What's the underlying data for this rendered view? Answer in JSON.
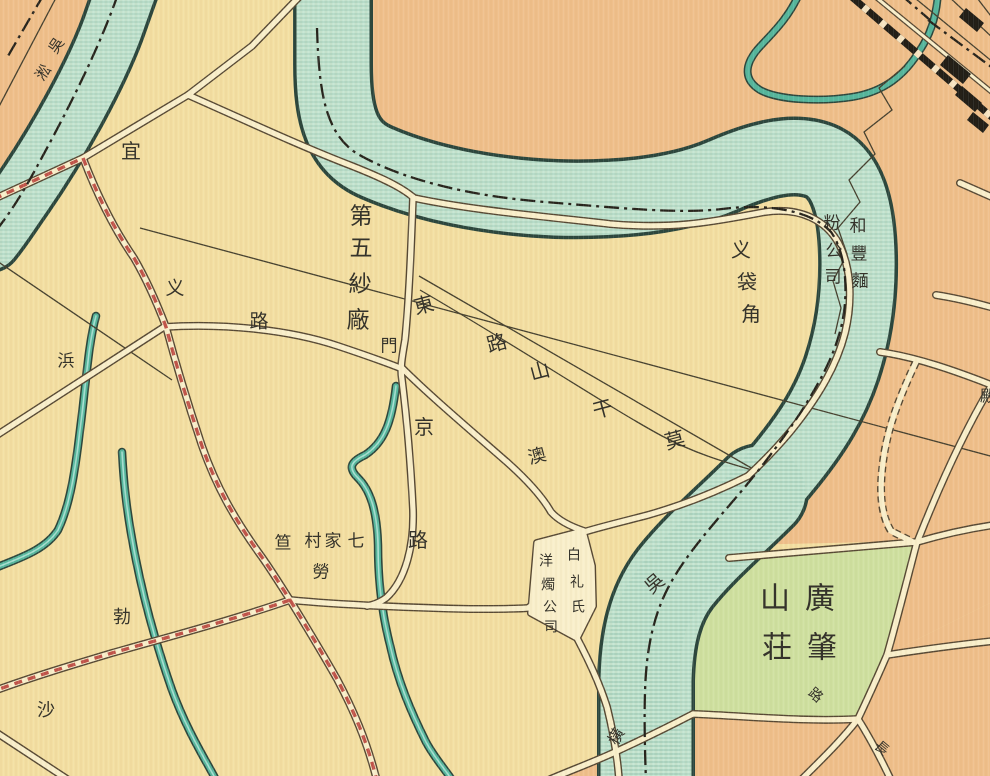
{
  "map": {
    "kind": "historical-chinese-city-map",
    "description_visible_features": "River bend with boundary dash-dot line, roads, factory district, cemetery green, railway in upper right",
    "palette": {
      "land_cream": "#f3dfa2",
      "land_orange": "#efbf8b",
      "land_green": "#cfe0a0",
      "water_fill": "#c5e5d1",
      "water_outline": "#2b463d",
      "water_hatch": "#84bba7",
      "water_small": "#55b69d",
      "water_small_hi": "#a5ded0",
      "road_fill": "#f9efcb",
      "road_casing": "#564834",
      "red_road": "#c0544a",
      "thin_line": "#45402f",
      "boundary": "#26231c",
      "rail": "#211e17",
      "ink": "#35332b"
    },
    "labels": [
      {
        "name": "label-yichang-road",
        "text": "宜",
        "chars": [
          {
            "c": "宜",
            "x": 131,
            "y": 152,
            "r": 0,
            "s": 20
          }
        ]
      },
      {
        "name": "label-creek-nw",
        "text": "吳淞",
        "chars": [
          {
            "c": "吳",
            "x": 57,
            "y": 46,
            "r": -55,
            "s": 15
          },
          {
            "c": "淞",
            "x": 44,
            "y": 73,
            "r": -55,
            "s": 15
          }
        ]
      },
      {
        "name": "label-no5-cotton-mill",
        "text": "第五紗廠",
        "chars": [
          {
            "c": "第",
            "x": 361,
            "y": 216,
            "r": 0,
            "s": 23
          },
          {
            "c": "五",
            "x": 361,
            "y": 248,
            "r": 0,
            "s": 23
          },
          {
            "c": "紗",
            "x": 360,
            "y": 284,
            "r": 0,
            "s": 23
          },
          {
            "c": "廠",
            "x": 358,
            "y": 320,
            "r": 0,
            "s": 23
          }
        ]
      },
      {
        "name": "label-gate",
        "text": "門",
        "chars": [
          {
            "c": "門",
            "x": 389,
            "y": 346,
            "r": 0,
            "s": 17
          }
        ]
      },
      {
        "name": "label-mokanshan-road-east",
        "text": "莫干山路東",
        "chars": [
          {
            "c": "東",
            "x": 424,
            "y": 306,
            "r": -15,
            "s": 20
          },
          {
            "c": "路",
            "x": 497,
            "y": 344,
            "r": -15,
            "s": 20
          },
          {
            "c": "山",
            "x": 540,
            "y": 372,
            "r": -15,
            "s": 20
          },
          {
            "c": "干",
            "x": 603,
            "y": 410,
            "r": -15,
            "s": 20
          },
          {
            "c": "莫",
            "x": 675,
            "y": 441,
            "r": -15,
            "s": 20
          }
        ]
      },
      {
        "name": "label-yi-road-west",
        "text": "义路",
        "chars": [
          {
            "c": "义",
            "x": 175,
            "y": 289,
            "r": 0,
            "s": 19
          },
          {
            "c": "路",
            "x": 259,
            "y": 322,
            "r": 0,
            "s": 19
          }
        ]
      },
      {
        "name": "label-bang-creek",
        "text": "浜",
        "chars": [
          {
            "c": "浜",
            "x": 66,
            "y": 361,
            "r": 0,
            "s": 17
          }
        ]
      },
      {
        "name": "label-jing-road",
        "text": "京路",
        "chars": [
          {
            "c": "京",
            "x": 424,
            "y": 428,
            "r": 0,
            "s": 20
          },
          {
            "c": "路",
            "x": 418,
            "y": 541,
            "r": 0,
            "s": 20
          }
        ]
      },
      {
        "name": "label-macao-road",
        "text": "澳",
        "chars": [
          {
            "c": "澳",
            "x": 537,
            "y": 456,
            "r": -15,
            "s": 18
          }
        ]
      },
      {
        "name": "label-yidaijiao",
        "text": "义袋角",
        "chars": [
          {
            "c": "义",
            "x": 741,
            "y": 251,
            "r": 0,
            "s": 20
          },
          {
            "c": "袋",
            "x": 747,
            "y": 283,
            "r": 0,
            "s": 20
          },
          {
            "c": "角",
            "x": 751,
            "y": 315,
            "r": 0,
            "s": 20
          }
        ]
      },
      {
        "name": "label-hefeng-flour-mill-right",
        "text": "和豐麵",
        "chars": [
          {
            "c": "和",
            "x": 858,
            "y": 226,
            "r": 0,
            "s": 17
          },
          {
            "c": "豐",
            "x": 859,
            "y": 254,
            "r": 0,
            "s": 17
          },
          {
            "c": "麵",
            "x": 860,
            "y": 281,
            "r": 0,
            "s": 17
          }
        ]
      },
      {
        "name": "label-hefeng-flour-mill-left",
        "text": "粉公司",
        "chars": [
          {
            "c": "粉",
            "x": 832,
            "y": 223,
            "r": 0,
            "s": 17
          },
          {
            "c": "公",
            "x": 834,
            "y": 251,
            "r": 0,
            "s": 17
          },
          {
            "c": "司",
            "x": 833,
            "y": 277,
            "r": 0,
            "s": 17
          }
        ]
      },
      {
        "name": "label-wusong-river",
        "text": "吳",
        "chars": [
          {
            "c": "吳",
            "x": 655,
            "y": 584,
            "r": -40,
            "s": 19
          }
        ]
      },
      {
        "name": "label-price-candle-right",
        "text": "白礼氏",
        "chars": [
          {
            "c": "白",
            "x": 574,
            "y": 556,
            "r": 0,
            "s": 14
          },
          {
            "c": "礼",
            "x": 577,
            "y": 583,
            "r": 0,
            "s": 14
          },
          {
            "c": "氏",
            "x": 578,
            "y": 608,
            "r": 0,
            "s": 14
          }
        ]
      },
      {
        "name": "label-price-candle-left",
        "text": "洋燭公司",
        "chars": [
          {
            "c": "洋",
            "x": 546,
            "y": 562,
            "r": 0,
            "s": 14
          },
          {
            "c": "燭",
            "x": 548,
            "y": 586,
            "r": 0,
            "s": 14
          },
          {
            "c": "公",
            "x": 550,
            "y": 608,
            "r": 0,
            "s": 14
          },
          {
            "c": "司",
            "x": 551,
            "y": 628,
            "r": 0,
            "s": 14
          }
        ]
      },
      {
        "name": "label-qijiacun-village",
        "text": "七家村笪",
        "chars": [
          {
            "c": "七",
            "x": 356,
            "y": 541,
            "r": 0,
            "s": 17
          },
          {
            "c": "家",
            "x": 333,
            "y": 541,
            "r": 0,
            "s": 17
          },
          {
            "c": "村",
            "x": 313,
            "y": 541,
            "r": 0,
            "s": 17
          },
          {
            "c": "笪",
            "x": 283,
            "y": 543,
            "r": 0,
            "s": 17
          }
        ]
      },
      {
        "name": "label-robison-road-lao",
        "text": "勞",
        "chars": [
          {
            "c": "勞",
            "x": 321,
            "y": 572,
            "r": 0,
            "s": 17
          }
        ]
      },
      {
        "name": "label-robison-road-bo",
        "text": "勃",
        "chars": [
          {
            "c": "勃",
            "x": 122,
            "y": 617,
            "r": 0,
            "s": 18
          }
        ]
      },
      {
        "name": "label-sha",
        "text": "沙",
        "chars": [
          {
            "c": "沙",
            "x": 46,
            "y": 710,
            "r": 0,
            "s": 18
          }
        ]
      },
      {
        "name": "label-guangzhao-cemetery",
        "text": "廣肇山荘",
        "chars": [
          {
            "c": "廣",
            "x": 820,
            "y": 599,
            "r": 0,
            "s": 30
          },
          {
            "c": "山",
            "x": 775,
            "y": 599,
            "r": 0,
            "s": 30
          },
          {
            "c": "肇",
            "x": 822,
            "y": 648,
            "r": 0,
            "s": 30
          },
          {
            "c": "荘",
            "x": 777,
            "y": 648,
            "r": 0,
            "s": 30
          }
        ]
      },
      {
        "name": "label-road-se",
        "text": "路",
        "chars": [
          {
            "c": "路",
            "x": 815,
            "y": 696,
            "r": 40,
            "s": 14
          }
        ]
      },
      {
        "name": "label-chang-road",
        "text": "長",
        "chars": [
          {
            "c": "長",
            "x": 881,
            "y": 749,
            "r": 40,
            "s": 14
          }
        ]
      },
      {
        "name": "label-heng-bridge",
        "text": "橫",
        "chars": [
          {
            "c": "橫",
            "x": 617,
            "y": 737,
            "r": -60,
            "s": 16
          }
        ]
      },
      {
        "name": "label-edge-partial",
        "text": "殿",
        "chars": [
          {
            "c": "殿",
            "x": 988,
            "y": 397,
            "r": 0,
            "s": 16
          }
        ]
      }
    ]
  }
}
